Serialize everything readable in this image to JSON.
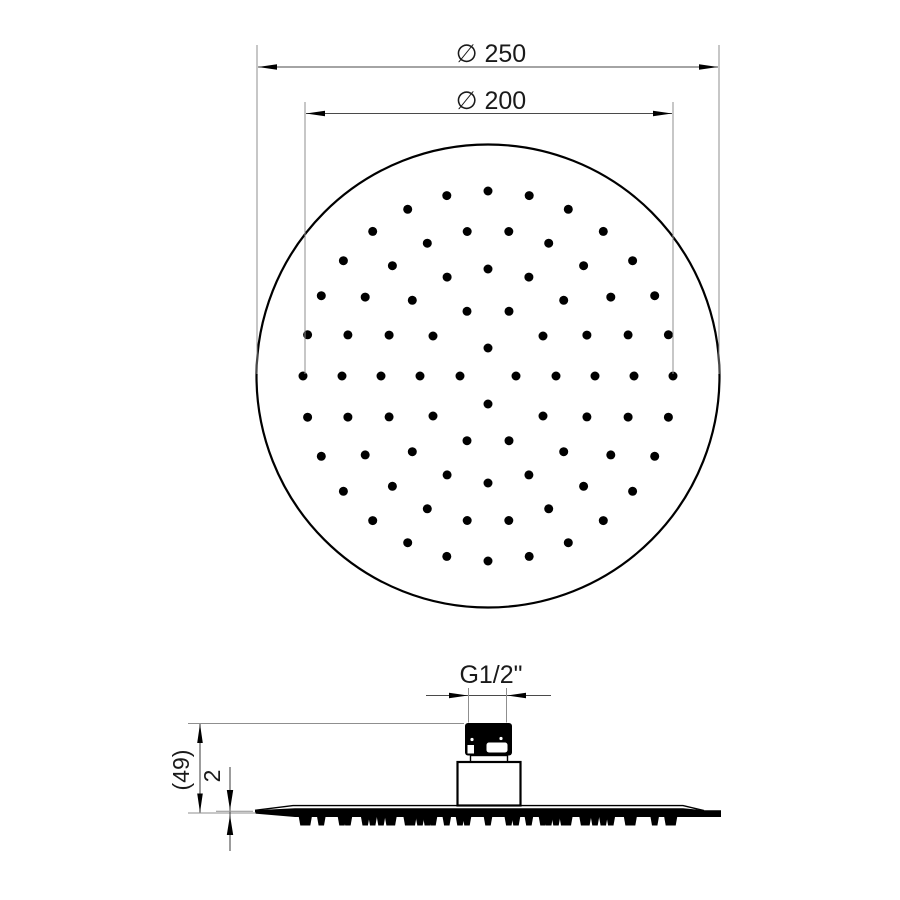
{
  "drawing": {
    "kind": "technical-dimension-drawing",
    "colors": {
      "background": "#ffffff",
      "object_line": "#000000",
      "dimension_line": "#4a4a4a",
      "extension_line": "#8f8f8f",
      "text": "#1a1a1a"
    },
    "dimensions": [
      {
        "name": "outer-diameter",
        "label": "∅ 250",
        "value": 250
      },
      {
        "name": "inner-diameter",
        "label": "∅ 200",
        "value": 200
      },
      {
        "name": "thread",
        "label": "G1/2\"",
        "value": "G1/2"
      },
      {
        "name": "height",
        "label": "(49)",
        "value": 49
      },
      {
        "name": "plate-thickness",
        "label": "2",
        "value": 2
      }
    ],
    "top_view": {
      "center_x": 488,
      "center_y": 376,
      "face_radius": 231.5,
      "dot_radius": 4.5,
      "nozzle_rings": [
        {
          "radius_px": 28,
          "count": 4
        },
        {
          "radius_px": 68,
          "count": 10
        },
        {
          "radius_px": 107,
          "count": 16
        },
        {
          "radius_px": 146,
          "count": 22
        },
        {
          "radius_px": 185,
          "count": 28
        }
      ]
    },
    "side_view": {
      "teeth": {
        "baseline_y": 816.5,
        "height": 9,
        "half_width_top": 4.3,
        "half_width_bottom": 2.7,
        "min_gap_px": 2
      }
    }
  }
}
